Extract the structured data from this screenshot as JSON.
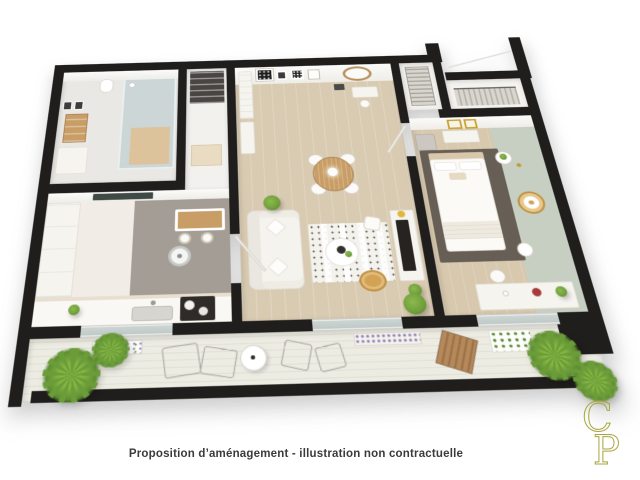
{
  "caption": "Proposition d’aménagement - illustration non contractuelle",
  "logo": {
    "c": "C",
    "p": "P"
  },
  "palette": {
    "wall": "#201e1c",
    "bath_floor": "#eae8e4",
    "hall_floor": "#f2f1ee",
    "kitchen_floor": "#f1ede6",
    "kitchen_gray": "#a49d95",
    "living_floor": "#d9cbb2",
    "bedroom_floor": "#d7c8ae",
    "sage": "#c6cfc2",
    "balcony_floor": "#edece3",
    "glass": "#ccd5d3",
    "wood": "#c99e66",
    "jute": "#d2a255",
    "rug_dark": "#675f55",
    "white_furniture": "#f6f4ef",
    "plant": "#6f9d3a",
    "lavender": "#8f80bd",
    "logo_color": "#a8a63e",
    "caption_color": "#3b3b3b"
  }
}
